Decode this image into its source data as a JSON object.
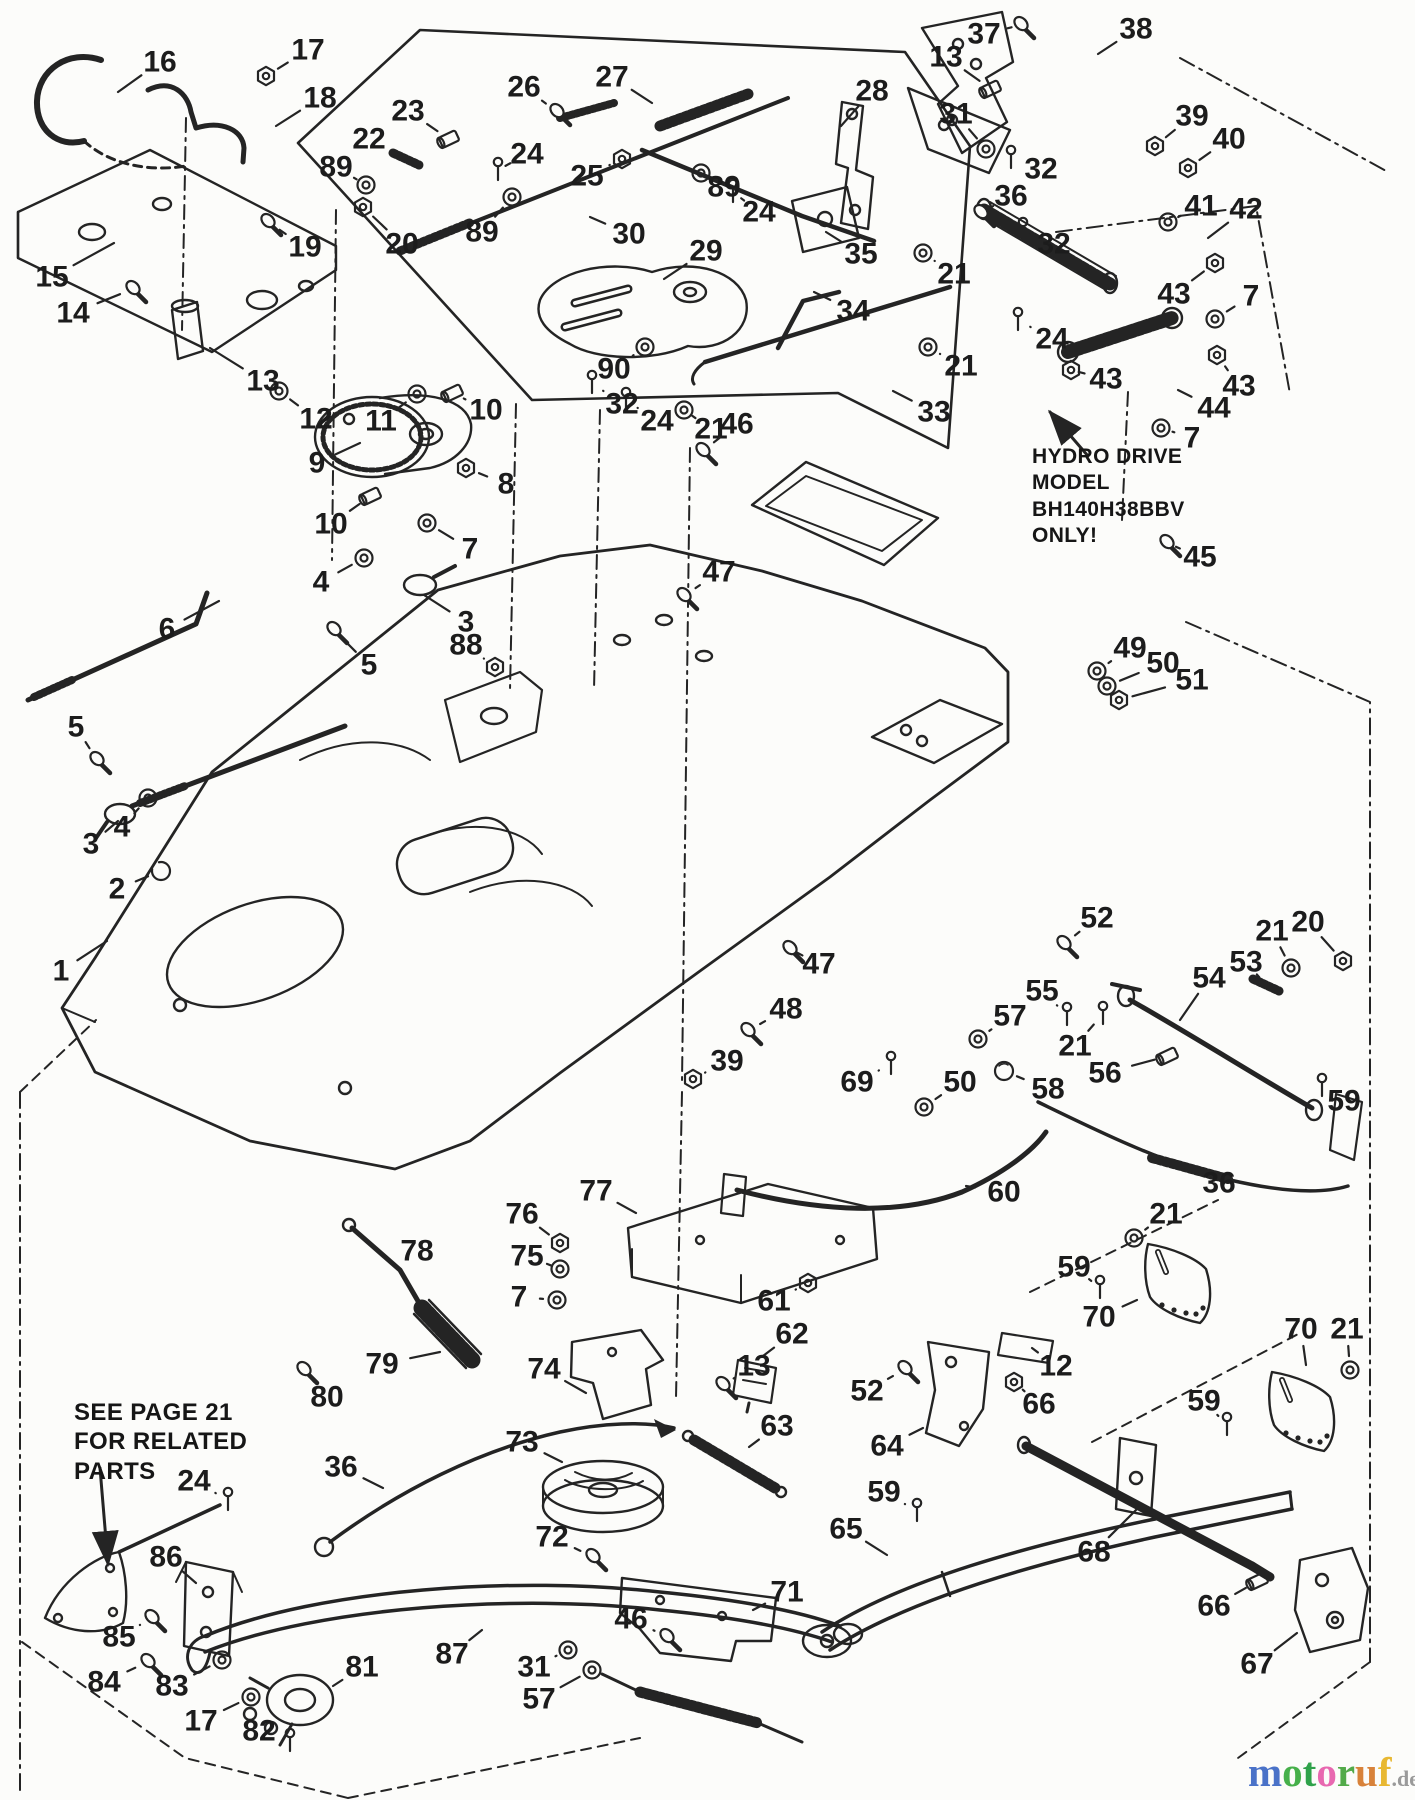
{
  "canvas": {
    "width": 1415,
    "height": 1800,
    "background": "#fcfcfa",
    "ink": "#242424"
  },
  "notes": {
    "hydro": {
      "text": "HYDRO DRIVE\nMODEL\nBH140H38BBV\nONLY!"
    },
    "see_page": {
      "text": "SEE PAGE 21\nFOR RELATED\nPARTS"
    }
  },
  "watermark": {
    "word": [
      {
        "ch": "m",
        "color": "#4a72c8"
      },
      {
        "ch": "o",
        "color": "#46b04a"
      },
      {
        "ch": "t",
        "color": "#2fa24a"
      },
      {
        "ch": "o",
        "color": "#e868b0"
      },
      {
        "ch": "r",
        "color": "#52aa49"
      },
      {
        "ch": "u",
        "color": "#d8823a"
      },
      {
        "ch": "f",
        "color": "#e8b832"
      }
    ],
    "suffix": ".de",
    "suffix_color": "#9a9a9a"
  },
  "callouts": [
    {
      "n": "16",
      "x": 160,
      "y": 62,
      "tx": 118,
      "ty": 92,
      "g": ""
    },
    {
      "n": "17",
      "x": 308,
      "y": 50,
      "tx": 266,
      "ty": 76,
      "g": "nut"
    },
    {
      "n": "18",
      "x": 320,
      "y": 98,
      "tx": 276,
      "ty": 126,
      "g": ""
    },
    {
      "n": "19",
      "x": 305,
      "y": 247,
      "tx": 268,
      "ty": 222,
      "g": "bolt"
    },
    {
      "n": "15",
      "x": 52,
      "y": 277,
      "tx": 114,
      "ty": 243,
      "g": ""
    },
    {
      "n": "14",
      "x": 73,
      "y": 313,
      "tx": 133,
      "ty": 289,
      "g": "bolt"
    },
    {
      "n": "13",
      "x": 263,
      "y": 381,
      "tx": 210,
      "ty": 348,
      "g": ""
    },
    {
      "n": "12",
      "x": 316,
      "y": 419,
      "tx": 279,
      "ty": 391,
      "g": "washer"
    },
    {
      "n": "11",
      "x": 381,
      "y": 421,
      "tx": 417,
      "ty": 394,
      "g": "washer"
    },
    {
      "n": "10",
      "x": 486,
      "y": 410,
      "tx": 453,
      "ty": 393,
      "g": "cyl"
    },
    {
      "n": "9",
      "x": 317,
      "y": 463,
      "tx": 360,
      "ty": 443,
      "g": ""
    },
    {
      "n": "8",
      "x": 506,
      "y": 484,
      "tx": 466,
      "ty": 468,
      "g": "nut"
    },
    {
      "n": "10",
      "x": 331,
      "y": 524,
      "tx": 371,
      "ty": 496,
      "g": "cyl"
    },
    {
      "n": "7",
      "x": 470,
      "y": 549,
      "tx": 427,
      "ty": 523,
      "g": "washer"
    },
    {
      "n": "4",
      "x": 321,
      "y": 582,
      "tx": 364,
      "ty": 558,
      "g": "washer"
    },
    {
      "n": "3",
      "x": 466,
      "y": 622,
      "tx": 424,
      "ty": 595,
      "g": ""
    },
    {
      "n": "6",
      "x": 167,
      "y": 629,
      "tx": 219,
      "ty": 601,
      "g": ""
    },
    {
      "n": "5",
      "x": 369,
      "y": 665,
      "tx": 334,
      "ty": 630,
      "g": "bolt"
    },
    {
      "n": "5",
      "x": 76,
      "y": 727,
      "tx": 97,
      "ty": 760,
      "g": "bolt"
    },
    {
      "n": "4",
      "x": 122,
      "y": 827,
      "tx": 148,
      "ty": 798,
      "g": "washer"
    },
    {
      "n": "3",
      "x": 91,
      "y": 844,
      "tx": 118,
      "ty": 821,
      "g": ""
    },
    {
      "n": "2",
      "x": 117,
      "y": 889,
      "tx": 161,
      "ty": 871,
      "g": "ring"
    },
    {
      "n": "1",
      "x": 61,
      "y": 971,
      "tx": 107,
      "ty": 941,
      "g": ""
    },
    {
      "n": "23",
      "x": 408,
      "y": 111,
      "tx": 449,
      "ty": 139,
      "g": "cyl"
    },
    {
      "n": "22",
      "x": 369,
      "y": 139,
      "tx": 406,
      "ty": 159,
      "g": "spring"
    },
    {
      "n": "89",
      "x": 336,
      "y": 167,
      "tx": 366,
      "ty": 185,
      "g": "washer"
    },
    {
      "n": "20",
      "x": 402,
      "y": 244,
      "tx": 363,
      "ty": 207,
      "g": "nut"
    },
    {
      "n": "26",
      "x": 524,
      "y": 87,
      "tx": 557,
      "ty": 112,
      "g": "bolt"
    },
    {
      "n": "27",
      "x": 612,
      "y": 77,
      "tx": 652,
      "ty": 103,
      "g": ""
    },
    {
      "n": "28",
      "x": 872,
      "y": 91,
      "tx": 841,
      "ty": 126,
      "g": ""
    },
    {
      "n": "24",
      "x": 527,
      "y": 154,
      "tx": 498,
      "ty": 170,
      "g": "pin"
    },
    {
      "n": "25",
      "x": 587,
      "y": 176,
      "tx": 622,
      "ty": 159,
      "g": "nut"
    },
    {
      "n": "89",
      "x": 482,
      "y": 232,
      "tx": 512,
      "ty": 197,
      "g": "washer"
    },
    {
      "n": "30",
      "x": 629,
      "y": 234,
      "tx": 590,
      "ty": 217,
      "g": ""
    },
    {
      "n": "29",
      "x": 706,
      "y": 251,
      "tx": 664,
      "ty": 279,
      "g": ""
    },
    {
      "n": "89",
      "x": 724,
      "y": 187,
      "tx": 701,
      "ty": 173,
      "g": "washer"
    },
    {
      "n": "24",
      "x": 759,
      "y": 212,
      "tx": 733,
      "ty": 192,
      "g": "pin"
    },
    {
      "n": "35",
      "x": 861,
      "y": 254,
      "tx": 826,
      "ty": 232,
      "g": ""
    },
    {
      "n": "34",
      "x": 853,
      "y": 311,
      "tx": 814,
      "ty": 292,
      "g": ""
    },
    {
      "n": "90",
      "x": 614,
      "y": 369,
      "tx": 645,
      "ty": 347,
      "g": "washer"
    },
    {
      "n": "32",
      "x": 622,
      "y": 404,
      "tx": 592,
      "ty": 383,
      "g": "pin"
    },
    {
      "n": "24",
      "x": 657,
      "y": 421,
      "tx": 626,
      "ty": 400,
      "g": "pin"
    },
    {
      "n": "21",
      "x": 711,
      "y": 429,
      "tx": 684,
      "ty": 410,
      "g": "washer"
    },
    {
      "n": "33",
      "x": 934,
      "y": 412,
      "tx": 893,
      "ty": 391,
      "g": ""
    },
    {
      "n": "21",
      "x": 961,
      "y": 366,
      "tx": 928,
      "ty": 347,
      "g": "washer"
    },
    {
      "n": "24",
      "x": 1052,
      "y": 339,
      "tx": 1018,
      "ty": 320,
      "g": "pin"
    },
    {
      "n": "37",
      "x": 984,
      "y": 34,
      "tx": 1021,
      "ty": 25,
      "g": "bolt"
    },
    {
      "n": "38",
      "x": 1136,
      "y": 29,
      "tx": 1098,
      "ty": 54,
      "g": ""
    },
    {
      "n": "13",
      "x": 946,
      "y": 57,
      "tx": 991,
      "ty": 89,
      "g": "cyl"
    },
    {
      "n": "31",
      "x": 956,
      "y": 114,
      "tx": 986,
      "ty": 149,
      "g": "washer"
    },
    {
      "n": "39",
      "x": 1192,
      "y": 116,
      "tx": 1155,
      "ty": 146,
      "g": "nut"
    },
    {
      "n": "40",
      "x": 1229,
      "y": 139,
      "tx": 1188,
      "ty": 168,
      "g": "nut"
    },
    {
      "n": "32",
      "x": 1041,
      "y": 169,
      "tx": 1011,
      "ty": 158,
      "g": "pin"
    },
    {
      "n": "36",
      "x": 1011,
      "y": 196,
      "tx": 981,
      "ty": 213,
      "g": "bolt"
    },
    {
      "n": "41",
      "x": 1201,
      "y": 206,
      "tx": 1168,
      "ty": 222,
      "g": "washer"
    },
    {
      "n": "42",
      "x": 1246,
      "y": 209,
      "tx": 1208,
      "ty": 238,
      "g": ""
    },
    {
      "n": "32",
      "x": 1054,
      "y": 244,
      "tx": 1023,
      "ty": 230,
      "g": "pin"
    },
    {
      "n": "21",
      "x": 954,
      "y": 274,
      "tx": 923,
      "ty": 253,
      "g": "washer"
    },
    {
      "n": "43",
      "x": 1174,
      "y": 294,
      "tx": 1215,
      "ty": 263,
      "g": "nut"
    },
    {
      "n": "7",
      "x": 1251,
      "y": 296,
      "tx": 1215,
      "ty": 319,
      "g": "washer"
    },
    {
      "n": "43",
      "x": 1106,
      "y": 379,
      "tx": 1071,
      "ty": 370,
      "g": "nut"
    },
    {
      "n": "43",
      "x": 1239,
      "y": 386,
      "tx": 1217,
      "ty": 355,
      "g": "nut"
    },
    {
      "n": "44",
      "x": 1214,
      "y": 408,
      "tx": 1178,
      "ty": 390,
      "g": ""
    },
    {
      "n": "7",
      "x": 1192,
      "y": 438,
      "tx": 1161,
      "ty": 428,
      "g": "washer"
    },
    {
      "n": "45",
      "x": 1200,
      "y": 557,
      "tx": 1167,
      "ty": 543,
      "g": "bolt"
    },
    {
      "n": "46",
      "x": 737,
      "y": 424,
      "tx": 703,
      "ty": 451,
      "g": "bolt"
    },
    {
      "n": "47",
      "x": 719,
      "y": 572,
      "tx": 684,
      "ty": 596,
      "g": "bolt"
    },
    {
      "n": "88",
      "x": 466,
      "y": 645,
      "tx": 495,
      "ty": 667,
      "g": "nut"
    },
    {
      "n": "47",
      "x": 819,
      "y": 964,
      "tx": 790,
      "ty": 949,
      "g": "bolt"
    },
    {
      "n": "48",
      "x": 786,
      "y": 1009,
      "tx": 748,
      "ty": 1031,
      "g": "bolt"
    },
    {
      "n": "39",
      "x": 727,
      "y": 1061,
      "tx": 693,
      "ty": 1079,
      "g": "nut"
    },
    {
      "n": "49",
      "x": 1130,
      "y": 648,
      "tx": 1097,
      "ty": 671,
      "g": "washer"
    },
    {
      "n": "50",
      "x": 1163,
      "y": 663,
      "tx": 1107,
      "ty": 686,
      "g": "washer"
    },
    {
      "n": "51",
      "x": 1192,
      "y": 680,
      "tx": 1119,
      "ty": 700,
      "g": "nut"
    },
    {
      "n": "52",
      "x": 1097,
      "y": 918,
      "tx": 1064,
      "ty": 944,
      "g": "bolt"
    },
    {
      "n": "21",
      "x": 1272,
      "y": 931,
      "tx": 1291,
      "ty": 968,
      "g": "washer"
    },
    {
      "n": "20",
      "x": 1308,
      "y": 922,
      "tx": 1343,
      "ty": 961,
      "g": "nut"
    },
    {
      "n": "53",
      "x": 1246,
      "y": 962,
      "tx": 1266,
      "ty": 985,
      "g": "spring"
    },
    {
      "n": "54",
      "x": 1209,
      "y": 978,
      "tx": 1180,
      "ty": 1020,
      "g": ""
    },
    {
      "n": "55",
      "x": 1042,
      "y": 991,
      "tx": 1067,
      "ty": 1015,
      "g": "pin"
    },
    {
      "n": "57",
      "x": 1010,
      "y": 1016,
      "tx": 978,
      "ty": 1039,
      "g": "washer"
    },
    {
      "n": "21",
      "x": 1075,
      "y": 1046,
      "tx": 1103,
      "ty": 1014,
      "g": "pin"
    },
    {
      "n": "56",
      "x": 1105,
      "y": 1073,
      "tx": 1168,
      "ty": 1056,
      "g": "cyl"
    },
    {
      "n": "50",
      "x": 960,
      "y": 1082,
      "tx": 924,
      "ty": 1107,
      "g": "washer"
    },
    {
      "n": "58",
      "x": 1048,
      "y": 1089,
      "tx": 1004,
      "ty": 1071,
      "g": "ball"
    },
    {
      "n": "69",
      "x": 857,
      "y": 1082,
      "tx": 891,
      "ty": 1064,
      "g": "pin"
    },
    {
      "n": "59",
      "x": 1344,
      "y": 1101,
      "tx": 1322,
      "ty": 1086,
      "g": "pin"
    },
    {
      "n": "36",
      "x": 1219,
      "y": 1183,
      "tx": 1183,
      "ty": 1169,
      "g": ""
    },
    {
      "n": "60",
      "x": 1004,
      "y": 1192,
      "tx": 966,
      "ty": 1186,
      "g": ""
    },
    {
      "n": "21",
      "x": 1166,
      "y": 1214,
      "tx": 1134,
      "ty": 1238,
      "g": "washer"
    },
    {
      "n": "59",
      "x": 1074,
      "y": 1267,
      "tx": 1100,
      "ty": 1288,
      "g": "pin"
    },
    {
      "n": "70",
      "x": 1099,
      "y": 1317,
      "tx": 1137,
      "ty": 1300,
      "g": ""
    },
    {
      "n": "70",
      "x": 1301,
      "y": 1329,
      "tx": 1306,
      "ty": 1365,
      "g": ""
    },
    {
      "n": "21",
      "x": 1347,
      "y": 1329,
      "tx": 1350,
      "ty": 1370,
      "g": "washer"
    },
    {
      "n": "12",
      "x": 1056,
      "y": 1366,
      "tx": 1032,
      "ty": 1348,
      "g": ""
    },
    {
      "n": "66",
      "x": 1039,
      "y": 1404,
      "tx": 1014,
      "ty": 1382,
      "g": "nut"
    },
    {
      "n": "59",
      "x": 1204,
      "y": 1401,
      "tx": 1227,
      "ty": 1425,
      "g": "pin"
    },
    {
      "n": "68",
      "x": 1094,
      "y": 1552,
      "tx": 1138,
      "ty": 1508,
      "g": ""
    },
    {
      "n": "66",
      "x": 1214,
      "y": 1606,
      "tx": 1258,
      "ty": 1581,
      "g": "cyl"
    },
    {
      "n": "67",
      "x": 1257,
      "y": 1664,
      "tx": 1297,
      "ty": 1633,
      "g": ""
    },
    {
      "n": "77",
      "x": 596,
      "y": 1191,
      "tx": 636,
      "ty": 1213,
      "g": ""
    },
    {
      "n": "76",
      "x": 522,
      "y": 1214,
      "tx": 560,
      "ty": 1243,
      "g": "nut"
    },
    {
      "n": "78",
      "x": 417,
      "y": 1251,
      "tx": 397,
      "ty": 1238,
      "g": ""
    },
    {
      "n": "75",
      "x": 527,
      "y": 1256,
      "tx": 560,
      "ty": 1269,
      "g": "washer"
    },
    {
      "n": "7",
      "x": 519,
      "y": 1297,
      "tx": 557,
      "ty": 1300,
      "g": "washer"
    },
    {
      "n": "61",
      "x": 774,
      "y": 1301,
      "tx": 808,
      "ty": 1283,
      "g": "nut"
    },
    {
      "n": "62",
      "x": 792,
      "y": 1334,
      "tx": 763,
      "ty": 1356,
      "g": ""
    },
    {
      "n": "74",
      "x": 544,
      "y": 1369,
      "tx": 586,
      "ty": 1393,
      "g": ""
    },
    {
      "n": "13",
      "x": 754,
      "y": 1366,
      "tx": 723,
      "ty": 1385,
      "g": "bolt"
    },
    {
      "n": "79",
      "x": 382,
      "y": 1364,
      "tx": 440,
      "ty": 1352,
      "g": ""
    },
    {
      "n": "80",
      "x": 327,
      "y": 1397,
      "tx": 304,
      "ty": 1370,
      "g": "bolt"
    },
    {
      "n": "52",
      "x": 867,
      "y": 1391,
      "tx": 905,
      "ty": 1369,
      "g": "bolt"
    },
    {
      "n": "63",
      "x": 777,
      "y": 1426,
      "tx": 749,
      "ty": 1447,
      "g": ""
    },
    {
      "n": "64",
      "x": 887,
      "y": 1446,
      "tx": 923,
      "ty": 1428,
      "g": ""
    },
    {
      "n": "73",
      "x": 522,
      "y": 1442,
      "tx": 562,
      "ty": 1462,
      "g": ""
    },
    {
      "n": "36",
      "x": 341,
      "y": 1467,
      "tx": 383,
      "ty": 1488,
      "g": ""
    },
    {
      "n": "59",
      "x": 884,
      "y": 1492,
      "tx": 917,
      "ty": 1511,
      "g": "pin"
    },
    {
      "n": "65",
      "x": 846,
      "y": 1529,
      "tx": 887,
      "ty": 1555,
      "g": ""
    },
    {
      "n": "72",
      "x": 552,
      "y": 1537,
      "tx": 593,
      "ty": 1557,
      "g": "bolt"
    },
    {
      "n": "71",
      "x": 787,
      "y": 1592,
      "tx": 753,
      "ty": 1610,
      "g": ""
    },
    {
      "n": "46",
      "x": 631,
      "y": 1619,
      "tx": 667,
      "ty": 1637,
      "g": "bolt"
    },
    {
      "n": "87",
      "x": 452,
      "y": 1654,
      "tx": 482,
      "ty": 1630,
      "g": ""
    },
    {
      "n": "81",
      "x": 362,
      "y": 1667,
      "tx": 333,
      "ty": 1686,
      "g": ""
    },
    {
      "n": "31",
      "x": 534,
      "y": 1667,
      "tx": 568,
      "ty": 1650,
      "g": "washer"
    },
    {
      "n": "57",
      "x": 539,
      "y": 1699,
      "tx": 592,
      "ty": 1670,
      "g": "washer"
    },
    {
      "n": "82",
      "x": 259,
      "y": 1731,
      "tx": 290,
      "ty": 1741,
      "g": "pin"
    },
    {
      "n": "24",
      "x": 194,
      "y": 1481,
      "tx": 228,
      "ty": 1500,
      "g": "pin"
    },
    {
      "n": "86",
      "x": 166,
      "y": 1557,
      "tx": 196,
      "ty": 1583,
      "g": ""
    },
    {
      "n": "85",
      "x": 119,
      "y": 1637,
      "tx": 152,
      "ty": 1618,
      "g": "bolt"
    },
    {
      "n": "84",
      "x": 104,
      "y": 1682,
      "tx": 148,
      "ty": 1662,
      "g": "bolt"
    },
    {
      "n": "83",
      "x": 172,
      "y": 1686,
      "tx": 222,
      "ty": 1660,
      "g": "washer"
    },
    {
      "n": "17",
      "x": 201,
      "y": 1721,
      "tx": 251,
      "ty": 1697,
      "g": "washer"
    }
  ]
}
